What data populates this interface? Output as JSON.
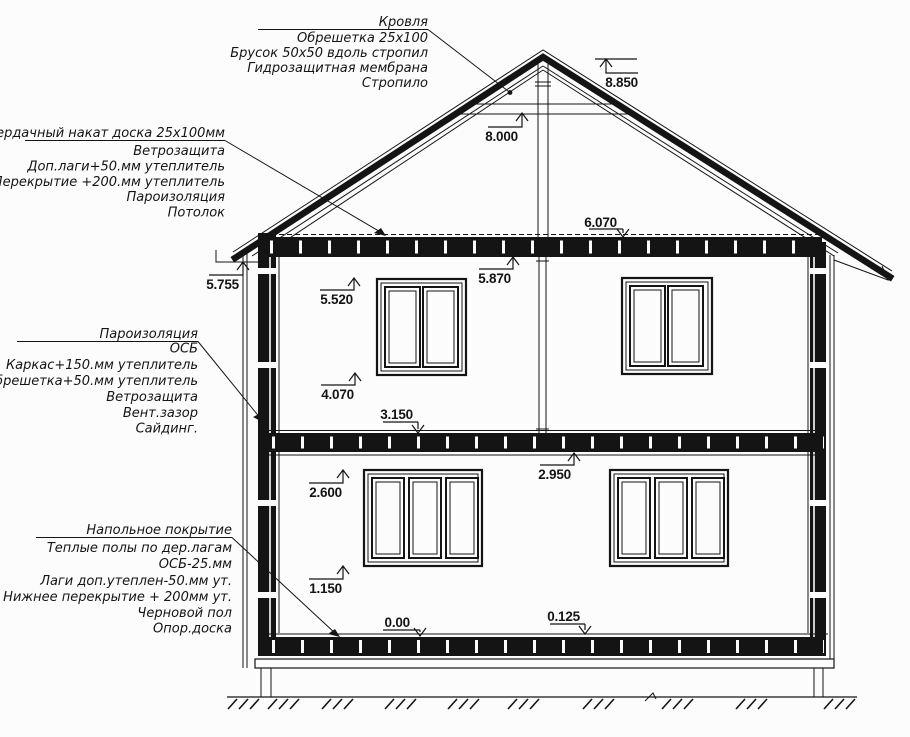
{
  "drawing_type": "house-section-drawing",
  "colors": {
    "ink": "#141414",
    "background": "#fcfcfc"
  },
  "callouts": {
    "roof": {
      "lines": [
        "Кровля",
        "Обрешетка 25x100",
        "Брусок 50x50 вдоль стропил",
        "Гидрозащитная мембрана",
        "Стропило"
      ]
    },
    "attic_floor": {
      "lines": [
        "Чердачный накат доска 25х100мм",
        "Ветрозащита",
        "Доп.лаги+50.мм утеплитель",
        "Перекрытие +200.мм утеплитель",
        "Пароизоляция",
        "Потолок"
      ]
    },
    "exterior_wall": {
      "lines": [
        "Пароизоляция",
        "ОСБ",
        "Каркас+150.мм утеплитель",
        "Обрешетка+50.мм утеплитель",
        "Ветрозащита",
        "Вент.зазор",
        "Сайдинг."
      ]
    },
    "ground_floor": {
      "lines": [
        "Напольное покрытие",
        "Теплые полы по дер.лагам",
        "ОСБ-25.мм",
        "Лаги доп.утеплен-50.мм ут.",
        "Нижнее перекрытие + 200мм ут.",
        "Черновой пол",
        "Опор.доска"
      ]
    }
  },
  "elevations": {
    "ridge": "8.850",
    "collar": "8.000",
    "attic_top": "6.070",
    "ceiling2": "5.870",
    "eave": "5.755",
    "win2_top": "5.520",
    "win2_sill": "4.070",
    "floor2": "3.150",
    "ceiling1": "2.950",
    "win1_top": "2.600",
    "win1_sill": "1.150",
    "zero": "0.00",
    "subfloor": "0.125"
  }
}
